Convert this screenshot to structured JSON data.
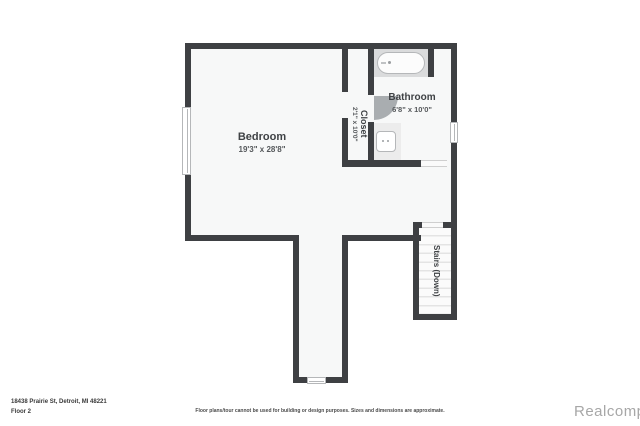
{
  "colors": {
    "wall": "#3e4043",
    "floor": "#f7f8f8",
    "fixbg": "#dadbdc",
    "fixline": "#b5b7b9",
    "door": "#a9adb0",
    "label": "#3f4245",
    "dim": "#55585b",
    "tread": "#e4e4e4",
    "watermark": "#a7a7a7"
  },
  "rooms": {
    "bedroom": {
      "name": "Bedroom",
      "dims": "19'3\" x 28'8\""
    },
    "closet": {
      "name": "Closet",
      "dims": "2'1\" x 10'0\""
    },
    "bathroom": {
      "name": "Bathroom",
      "dims": "6'8\" x 10'0\""
    },
    "stairs": {
      "name": "Stairs (Down)"
    }
  },
  "footer": {
    "address": "18438 Prairie St, Detroit, MI 48221",
    "floor_label": "Floor 2",
    "disclaimer": "Floor plans/tour cannot be used for building or design purposes. Sizes and dimensions are approximate.",
    "watermark": "Realcomp"
  }
}
